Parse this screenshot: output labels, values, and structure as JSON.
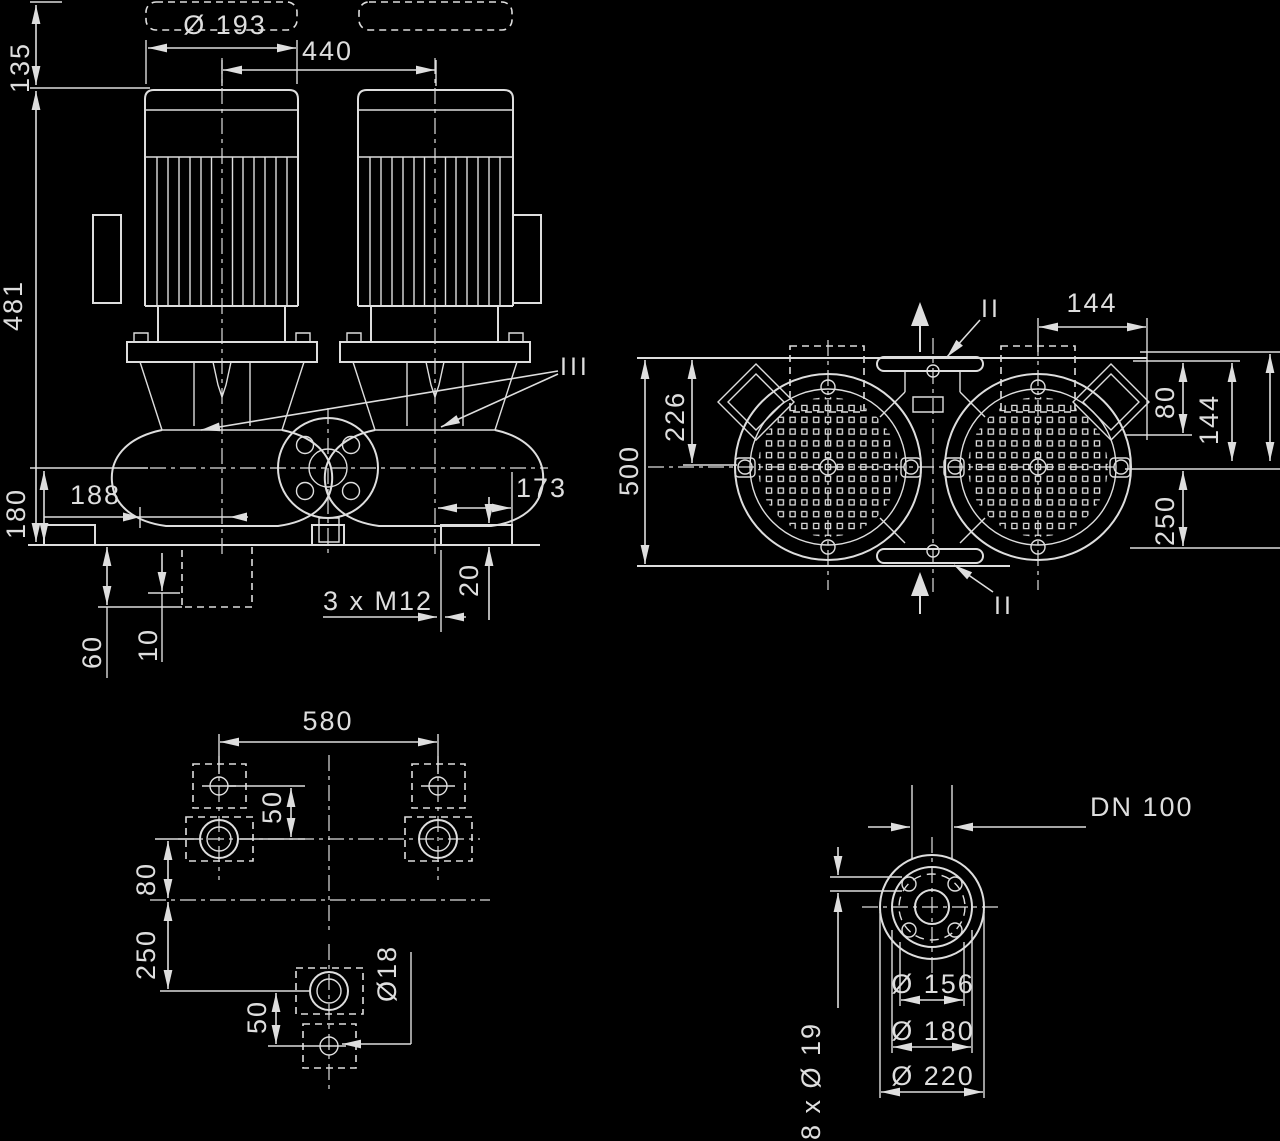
{
  "title": "Twin pump dimension drawing",
  "colors": {
    "background": "#000000",
    "line": "#dedede"
  },
  "front_view": {
    "dims": {
      "box_height": "135",
      "motor_diameter": "Ø 193",
      "motor_spacing": "440",
      "motor_height": "481",
      "axis_height": "180",
      "suction_offset": "188",
      "discharge_offset": "173",
      "foot_height": "20",
      "tapped_holes": "3 x M12",
      "port_depth": "60",
      "port_offset": "10"
    },
    "section_marker": "III"
  },
  "plan_view": {
    "dims": {
      "flange_edge": "144",
      "axis_to_front": "226",
      "total_depth": "500",
      "pad_offset": "80",
      "axis_to_edge": "144",
      "axis_to_back": "250"
    },
    "section_marker_top": "II",
    "section_marker_bottom": "II"
  },
  "foundation_view": {
    "dims": {
      "bolt_spacing": "580",
      "hole_offset_top": "50",
      "axis_offset": "80",
      "row_spacing": "250",
      "hole_offset_bottom": "50",
      "hole_diameter": "Ø18"
    }
  },
  "flange_view": {
    "nominal_diameter": "DN 100",
    "dims": {
      "bolt_circle": "Ø 156",
      "raised_face": "Ø 180",
      "outer_diameter": "Ø 220",
      "bolt_holes": "8 x Ø 19"
    }
  }
}
